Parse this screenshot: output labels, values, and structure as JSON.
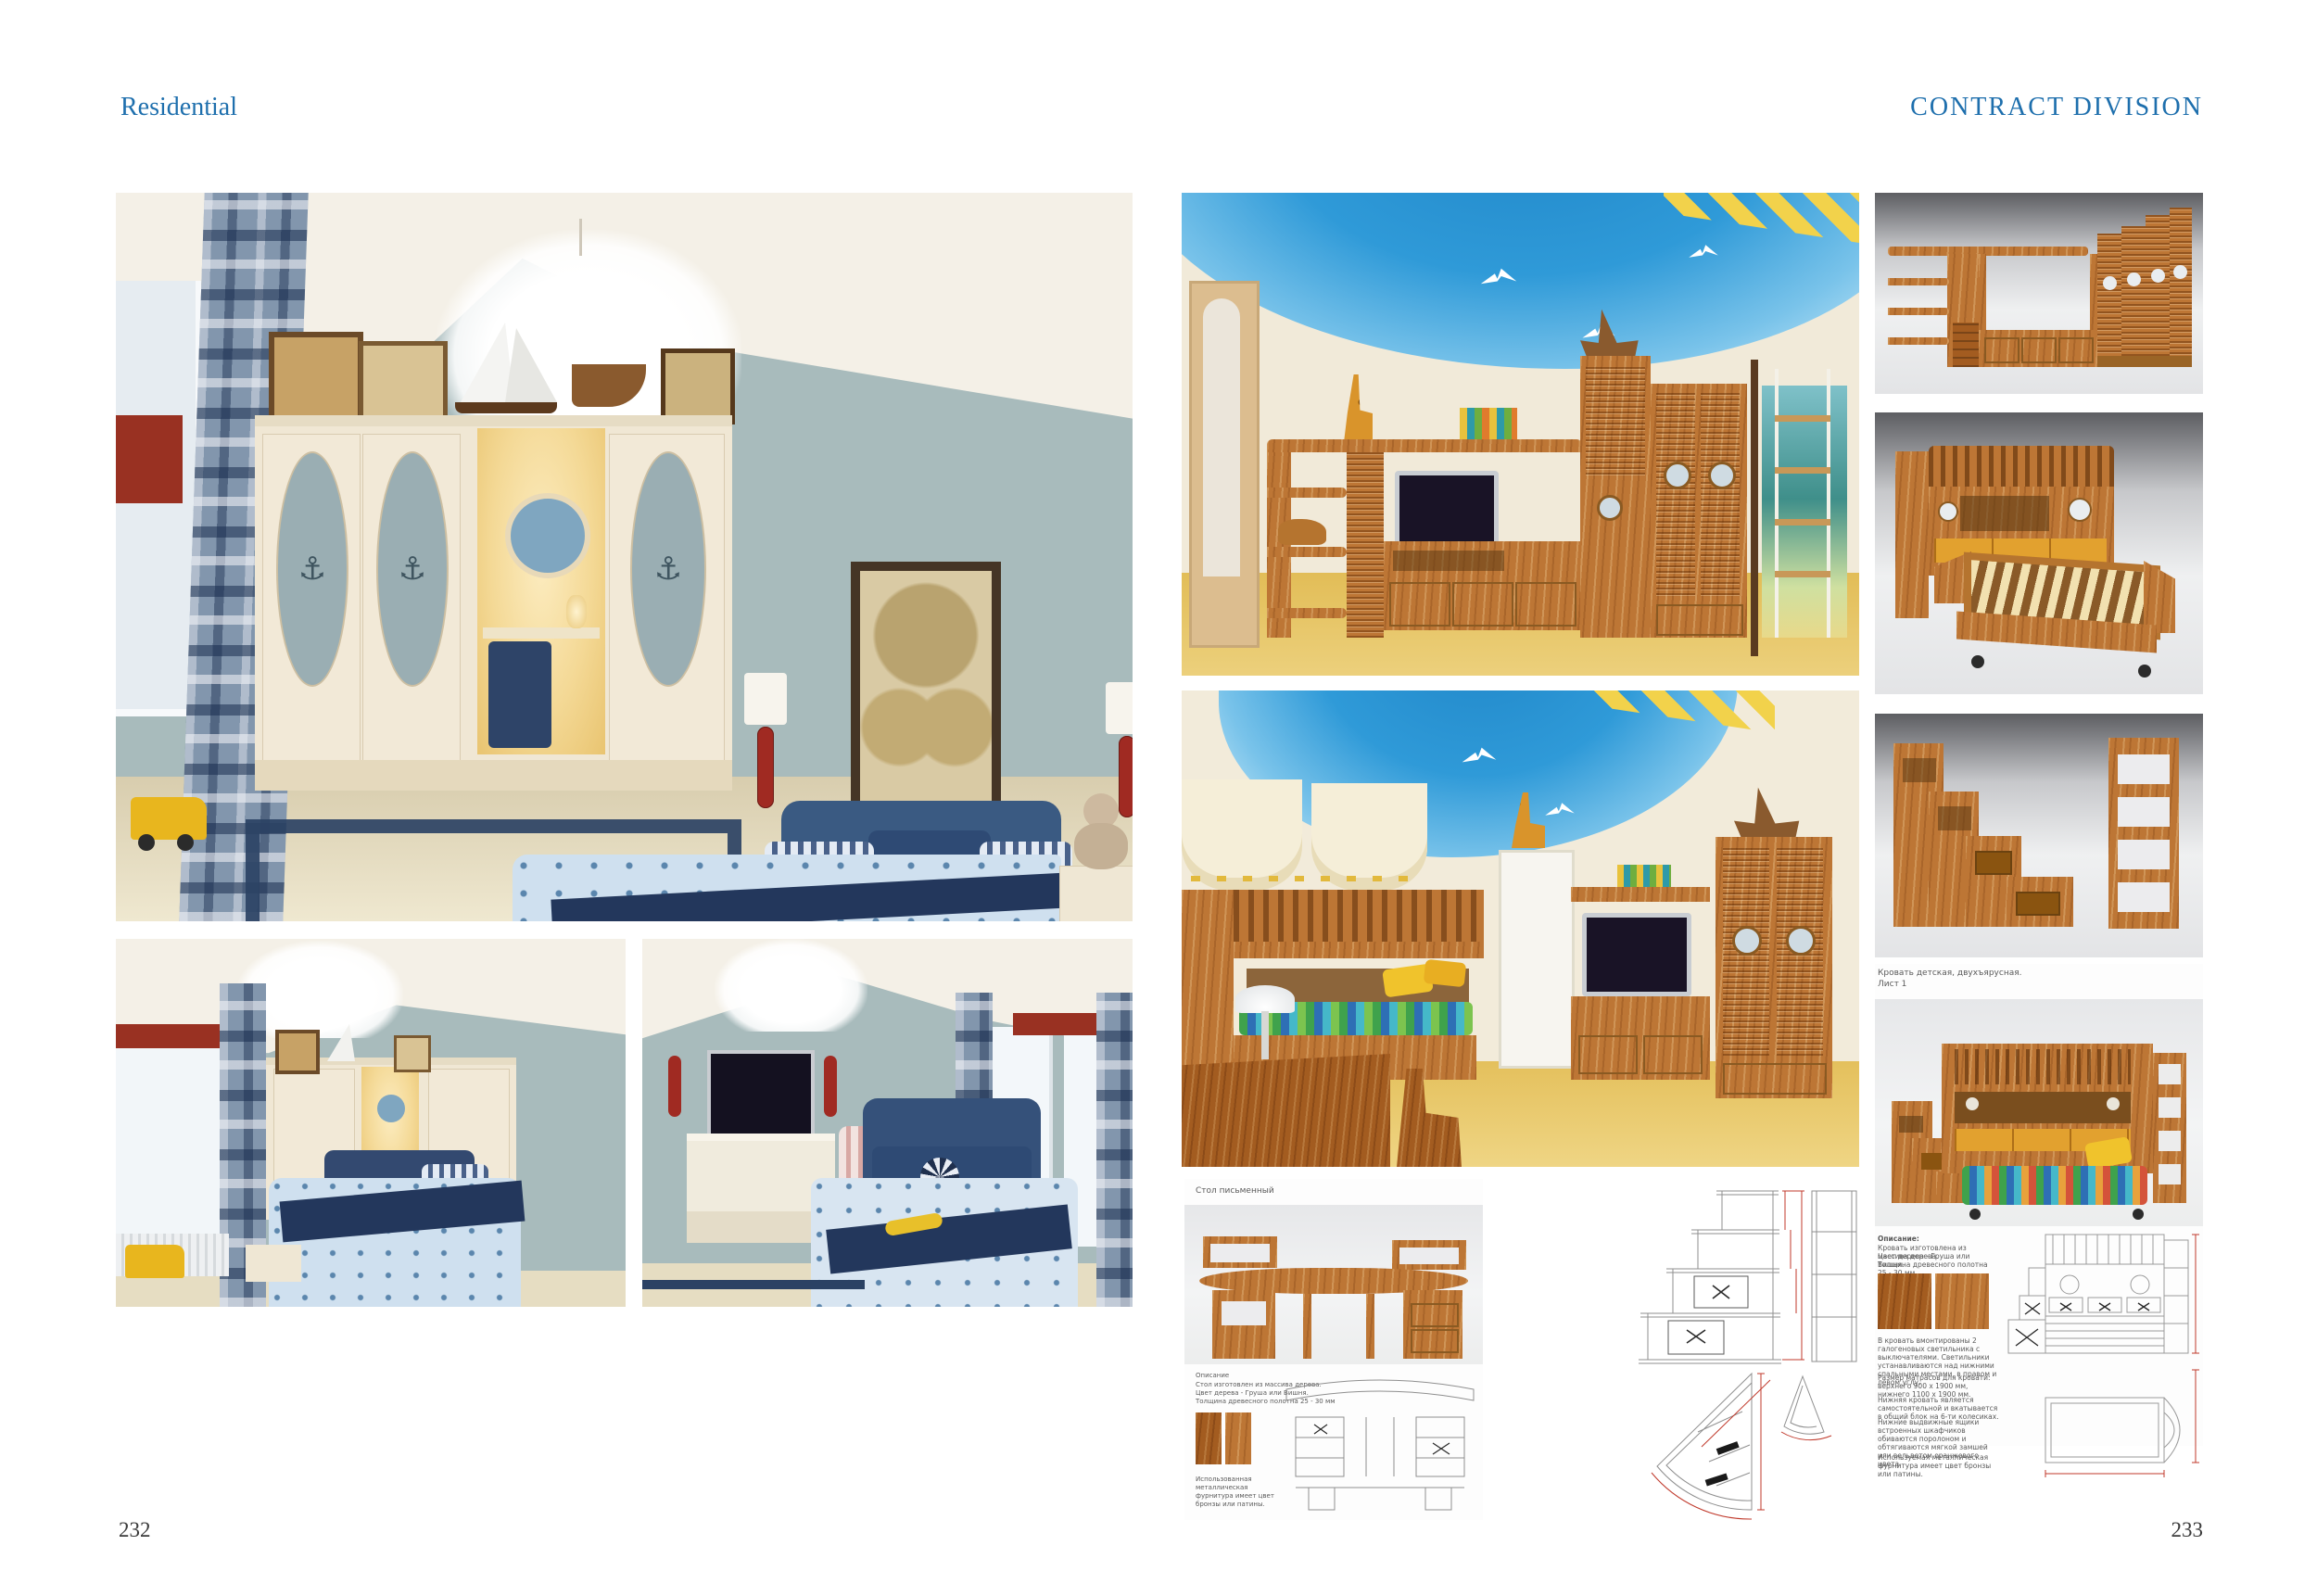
{
  "header": {
    "left_label": "Residential",
    "right_label": "CONTRACT DIVISION"
  },
  "footer": {
    "left_page_number": "232",
    "right_page_number": "233"
  },
  "colors": {
    "accent_blue": "#1e6fad",
    "wall_blue_grey": "#a8bbbc",
    "ceiling_cream": "#f4f0e7",
    "wood_orange": "#bd7635",
    "ceiling_sky_blue": "#2f97d6",
    "floor_yellow": "#e9c760",
    "navy": "#2b4264",
    "valance_red": "#993122"
  },
  "desk_sheet": {
    "title": "Стол письменный",
    "description_lines": [
      "Описание",
      "Стол изготовлен из массива дерева.",
      "Цвет дерева - Груша или Вишня.",
      "Толщина древесного полотна 25 - 30 мм"
    ],
    "footnote": "Использованная металлическая фурнитура имеет цвет бронзы или патины."
  },
  "bed_sheet": {
    "title": "Кровать детская, двухъярусная.",
    "sheet_label": "Лист 1",
    "description_heading": "Описание:",
    "description_lines": [
      "Кровать изготовлена из массива дерева.",
      "Цвет дерева - Груша или Вишня.",
      "Толщина древесного полотна 25 - 30 мм"
    ],
    "paragraphs": [
      "В кровать вмонтированы 2 галогеновых светильника с выключателями. Светильники устанавливаются над нижними спальными местами, в правом и левом углу.",
      "Размер матрасов для кровати: верхнего 900 х 1900 мм, нижнего 1100 х 1900 мм.",
      "Нижняя кровать является самостоятельной и вкатывается в общий блок на 6-ти колесиках.",
      "Нижние выдвижные ящики встроенных шкафчиков обиваются поролоном и обтягиваются мягкой замшей или вельветом оранжевого цвета.",
      "Используемая металлическая фурнитура имеет цвет бронзы или патины."
    ]
  }
}
